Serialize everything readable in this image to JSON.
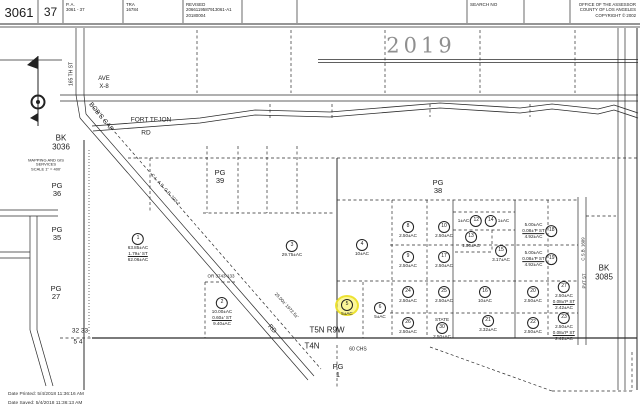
{
  "header": {
    "book": "3061",
    "page": "37",
    "pa_label": "P. A.",
    "pa_value": "3061 - 37",
    "tra_label": "TRA",
    "tra_value": "16784",
    "revised_label": "REVISED",
    "revised_value1": "2066119587913061-A1",
    "revised_value2": "20180004",
    "search_label": "SEARCH NO",
    "office_line1": "OFFICE OF THE ASSESSOR",
    "office_line2": "COUNTY OF LOS ANGELES",
    "office_line3": "COPYRIGHT © 2002"
  },
  "footer": {
    "printed": "Date Printed: 5/4/2018 11:36:16 AM",
    "saved": "Date Saved: 5/4/2018 11:36:13 AM"
  },
  "map": {
    "year": "2019",
    "highlight_color": "#f5ee46",
    "labels": [
      {
        "name": "year",
        "text": "2019",
        "x": 421,
        "y": 46,
        "size": 21,
        "color": "#8f8f8f",
        "ls": 4,
        "serif": true
      },
      {
        "name": "ave",
        "text": "AVE",
        "x": 104,
        "y": 79,
        "size": 6
      },
      {
        "name": "ave-x8",
        "text": "X-8",
        "x": 104,
        "y": 87,
        "size": 6
      },
      {
        "name": "fort-tejon",
        "text": "FORT TEJON",
        "x": 151,
        "y": 120,
        "size": 6.5
      },
      {
        "name": "fort-tejon-rd",
        "text": "RD",
        "x": 146,
        "y": 133,
        "size": 6.5
      },
      {
        "name": "bobs-gap",
        "text": "BOB'S GAP",
        "x": 101,
        "y": 117,
        "size": 6.5,
        "rot": 51
      },
      {
        "name": "bobs-gap-rd",
        "text": "RD",
        "x": 272,
        "y": 329,
        "size": 6.5,
        "rot": 48
      },
      {
        "name": "st-165th",
        "text": "165 TH  ST",
        "x": 72,
        "y": 74,
        "size": 5,
        "rot": -90
      },
      {
        "name": "easement-dims",
        "text": "25.00±'  1972.5±'",
        "x": 286,
        "y": 306,
        "size": 4.5,
        "rot": 48
      },
      {
        "name": "road-ref",
        "text": "C.L. A.B. G.B. 103-2",
        "x": 165,
        "y": 190,
        "size": 4.5,
        "rot": 48
      },
      {
        "name": "or-ref",
        "text": "OR 3743-133",
        "x": 221,
        "y": 277,
        "size": 4.5
      },
      {
        "name": "csb-1609",
        "text": "C.S.B. 1609",
        "x": 584,
        "y": 249,
        "size": 4.3,
        "rot": -90
      },
      {
        "name": "pvt-st",
        "text": "PVT ST",
        "x": 585,
        "y": 281,
        "size": 4.3,
        "rot": -90
      },
      {
        "name": "bk-3036",
        "text": "BK\n3036",
        "x": 61,
        "y": 143,
        "size": 8
      },
      {
        "name": "bk-3085",
        "text": "BK\n3085",
        "x": 604,
        "y": 273,
        "size": 8
      },
      {
        "name": "pg-36",
        "text": "PG\n36",
        "x": 57,
        "y": 190,
        "size": 7.5
      },
      {
        "name": "pg-35",
        "text": "PG\n35",
        "x": 57,
        "y": 234,
        "size": 7.5
      },
      {
        "name": "pg-27",
        "text": "PG\n27",
        "x": 56,
        "y": 293,
        "size": 7.5
      },
      {
        "name": "pg-39",
        "text": "PG\n39",
        "x": 220,
        "y": 177,
        "size": 7.5
      },
      {
        "name": "pg-38",
        "text": "PG\n38",
        "x": 438,
        "y": 187,
        "size": 7.5
      },
      {
        "name": "pg-1",
        "text": "PG\n1",
        "x": 338,
        "y": 371,
        "size": 7.5
      },
      {
        "name": "mapping-note",
        "text": "MAPPING AND GIS\nSERVICES\nSCALE 1\" = 400'",
        "x": 46,
        "y": 165,
        "size": 4
      },
      {
        "name": "sec-32-33",
        "text": "32  33",
        "x": 80,
        "y": 331,
        "size": 6.5
      },
      {
        "name": "sec-5-4",
        "text": "5  4",
        "x": 78,
        "y": 342,
        "size": 6.5
      },
      {
        "name": "t5n-r9w",
        "text": "T5N  R9W",
        "x": 327,
        "y": 331,
        "size": 8
      },
      {
        "name": "t4n",
        "text": "T4N",
        "x": 312,
        "y": 347,
        "size": 8
      },
      {
        "name": "chs-60",
        "text": "60 CHS",
        "x": 358,
        "y": 350,
        "size": 5
      }
    ],
    "parcels": [
      {
        "num": "1",
        "x": 138,
        "y": 240,
        "lines": [
          "63.85±AC",
          "1.79±' ST",
          "62.06±AC"
        ]
      },
      {
        "num": "2",
        "x": 222,
        "y": 304,
        "lines": [
          "10.00±AC",
          "0.60±' ST",
          "9.40±AC"
        ]
      },
      {
        "num": "3",
        "x": 292,
        "y": 247,
        "lines": [
          "29.75±AC"
        ]
      },
      {
        "num": "4",
        "x": 362,
        "y": 246,
        "lines": [
          "10±AC"
        ]
      },
      {
        "num": "5",
        "x": 347,
        "y": 306,
        "lines": [
          "5±AC"
        ],
        "highlighted": true
      },
      {
        "num": "6",
        "x": 380,
        "y": 309,
        "lines": [
          "5±AC"
        ]
      },
      {
        "num": "8",
        "x": 408,
        "y": 228,
        "lines": [
          "2.50±AC"
        ]
      },
      {
        "num": "10",
        "x": 444,
        "y": 228,
        "lines": [
          "2.50±AC"
        ]
      },
      {
        "num": "9",
        "x": 408,
        "y": 258,
        "lines": [
          "2.50±AC"
        ]
      },
      {
        "num": "17",
        "x": 444,
        "y": 258,
        "lines": [
          "2.50±AC"
        ]
      },
      {
        "num": "12",
        "x": 470,
        "y": 221,
        "lines": [
          "1±AC"
        ],
        "layout": "row-textfirst"
      },
      {
        "num": "14",
        "x": 497,
        "y": 221,
        "lines": [
          "1±AC"
        ],
        "layout": "row-circlefirst"
      },
      {
        "num": "13",
        "x": 471,
        "y": 238,
        "lines": [
          "1.50±AC"
        ]
      },
      {
        "num": "15",
        "x": 501,
        "y": 252,
        "lines": [
          "3.17±AC"
        ]
      },
      {
        "num": "18",
        "x": 540,
        "y": 231,
        "lines": [
          "5.00±AC",
          "0.08±'P ST",
          "4.92±AC"
        ],
        "layout": "row-textfirst"
      },
      {
        "num": "19",
        "x": 540,
        "y": 259,
        "lines": [
          "5.00±AC",
          "0.08±'P ST",
          "4.92±AC"
        ],
        "layout": "row-textfirst"
      },
      {
        "num": "24",
        "x": 408,
        "y": 293,
        "lines": [
          "2.50±AC"
        ]
      },
      {
        "num": "25",
        "x": 444,
        "y": 293,
        "lines": [
          "2.50±AC"
        ]
      },
      {
        "num": "16",
        "x": 485,
        "y": 293,
        "lines": [
          "10±AC"
        ]
      },
      {
        "num": "20",
        "x": 533,
        "y": 293,
        "lines": [
          "2.50±AC"
        ]
      },
      {
        "num": "27",
        "x": 564,
        "y": 288,
        "lines": [
          "2.50±AC",
          "0.08±'P ST",
          "2.42±AC"
        ]
      },
      {
        "num": "26",
        "x": 408,
        "y": 324,
        "lines": [
          "2.50±AC"
        ]
      },
      {
        "num": "30",
        "x": 442,
        "y": 324,
        "lines": [
          "2.50±AC"
        ],
        "state": "STATE"
      },
      {
        "num": "21",
        "x": 488,
        "y": 322,
        "lines": [
          "3.32±AC"
        ]
      },
      {
        "num": "22",
        "x": 533,
        "y": 324,
        "lines": [
          "2.50±AC"
        ]
      },
      {
        "num": "23",
        "x": 564,
        "y": 319,
        "lines": [
          "2.50±AC",
          "0.08±'P ST",
          "2.42±AC"
        ]
      }
    ],
    "lines": [
      [
        38,
        0,
        38,
        23
      ],
      [
        63,
        0,
        63,
        23
      ],
      [
        123,
        0,
        123,
        23
      ],
      [
        183,
        0,
        183,
        23
      ],
      [
        242,
        0,
        242,
        23
      ],
      [
        297,
        0,
        297,
        23
      ],
      [
        467,
        0,
        467,
        23
      ],
      [
        524,
        0,
        524,
        23
      ],
      [
        570,
        0,
        570,
        23
      ],
      [
        0,
        24,
        640,
        24,
        "H"
      ],
      [
        0,
        27,
        640,
        27
      ],
      [
        0,
        60,
        62,
        60
      ],
      [
        318,
        59.5,
        638,
        59.5
      ],
      [
        318,
        62.5,
        638,
        62.5
      ],
      [
        60,
        95,
        638,
        95
      ],
      [
        60,
        101,
        638,
        101
      ],
      [
        76,
        28,
        76,
        95
      ],
      [
        84,
        28,
        84,
        95
      ],
      [
        76,
        95,
        80,
        118
      ],
      [
        84,
        95,
        86,
        114
      ],
      [
        80,
        118,
        308,
        380
      ],
      [
        86,
        114,
        314,
        376
      ],
      [
        93,
        107,
        321,
        369,
        "d"
      ],
      [
        84,
        140,
        84,
        390,
        "H"
      ],
      [
        89,
        150,
        89,
        338,
        "t"
      ],
      [
        197,
        30,
        197,
        93,
        "d"
      ],
      [
        291,
        30,
        291,
        93,
        "d"
      ],
      [
        385,
        30,
        385,
        93,
        "d"
      ],
      [
        480,
        30,
        480,
        93,
        "d"
      ],
      [
        575,
        30,
        575,
        93,
        "d"
      ],
      [
        270,
        104,
        270,
        119,
        "d"
      ],
      [
        332,
        104,
        332,
        119,
        "d"
      ],
      [
        430,
        104,
        430,
        117,
        "d"
      ],
      [
        530,
        104,
        530,
        117,
        "d"
      ],
      [
        128,
        158,
        637,
        158,
        "d"
      ],
      [
        207,
        146,
        207,
        213,
        "d"
      ],
      [
        238,
        146,
        238,
        213,
        "d"
      ],
      [
        267,
        146,
        267,
        213,
        "d"
      ],
      [
        297,
        146,
        297,
        213,
        "d"
      ],
      [
        150,
        158,
        150,
        213,
        "d"
      ],
      [
        203,
        213,
        335,
        213,
        "d"
      ],
      [
        337,
        158,
        337,
        338,
        "H"
      ],
      [
        337,
        345,
        337,
        388,
        "d"
      ],
      [
        337,
        200,
        578,
        200,
        "d"
      ],
      [
        390,
        245,
        578,
        245,
        "d"
      ],
      [
        337,
        281,
        578,
        281,
        "d"
      ],
      [
        390,
        313,
        578,
        313,
        "d"
      ],
      [
        453,
        212,
        515,
        212,
        "d"
      ],
      [
        453,
        230,
        515,
        230,
        "d"
      ],
      [
        455,
        252,
        492,
        252,
        "d"
      ],
      [
        492,
        230,
        492,
        252,
        "d"
      ],
      [
        392,
        200,
        392,
        338,
        "d"
      ],
      [
        427,
        200,
        427,
        338,
        "d"
      ],
      [
        548,
        200,
        548,
        338,
        "d"
      ],
      [
        453,
        200,
        453,
        338
      ],
      [
        515,
        200,
        515,
        338
      ],
      [
        363,
        282,
        363,
        338,
        "d"
      ],
      [
        578,
        197,
        578,
        345
      ],
      [
        586,
        197,
        586,
        345
      ],
      [
        586,
        216,
        616,
        216,
        "d"
      ],
      [
        618,
        28,
        618,
        390
      ],
      [
        625,
        28,
        625,
        390
      ],
      [
        637,
        28,
        637,
        390,
        "H"
      ],
      [
        60,
        338,
        92,
        338,
        "d"
      ],
      [
        92,
        338,
        637,
        338,
        "h"
      ],
      [
        430,
        347,
        552,
        391,
        "d"
      ],
      [
        552,
        391,
        632,
        391,
        "d"
      ],
      [
        632,
        352,
        632,
        391,
        "d"
      ],
      [
        205,
        282,
        235,
        282,
        "d"
      ],
      [
        205,
        282,
        205,
        338,
        "d"
      ],
      [
        0,
        210,
        58,
        210
      ],
      [
        0,
        216,
        58,
        216
      ],
      [
        30,
        216,
        30,
        330
      ],
      [
        37,
        216,
        37,
        330
      ],
      [
        0,
        252,
        30,
        252
      ],
      [
        0,
        258,
        30,
        258
      ],
      [
        30,
        330,
        46,
        386
      ],
      [
        37,
        330,
        53,
        386
      ]
    ],
    "polylines": [
      [
        [
          92,
          126
        ],
        [
          200,
          118
        ],
        [
          255,
          110
        ],
        [
          330,
          112
        ],
        [
          440,
          103
        ],
        [
          520,
          108
        ],
        [
          552,
          104
        ],
        [
          598,
          109
        ],
        [
          614,
          105
        ],
        [
          638,
          113
        ]
      ],
      [
        [
          93,
          131
        ],
        [
          200,
          123
        ],
        [
          255,
          115
        ],
        [
          330,
          117
        ],
        [
          440,
          108
        ],
        [
          520,
          113
        ],
        [
          552,
          109
        ],
        [
          598,
          114
        ],
        [
          614,
          110
        ],
        [
          638,
          118
        ]
      ]
    ]
  }
}
